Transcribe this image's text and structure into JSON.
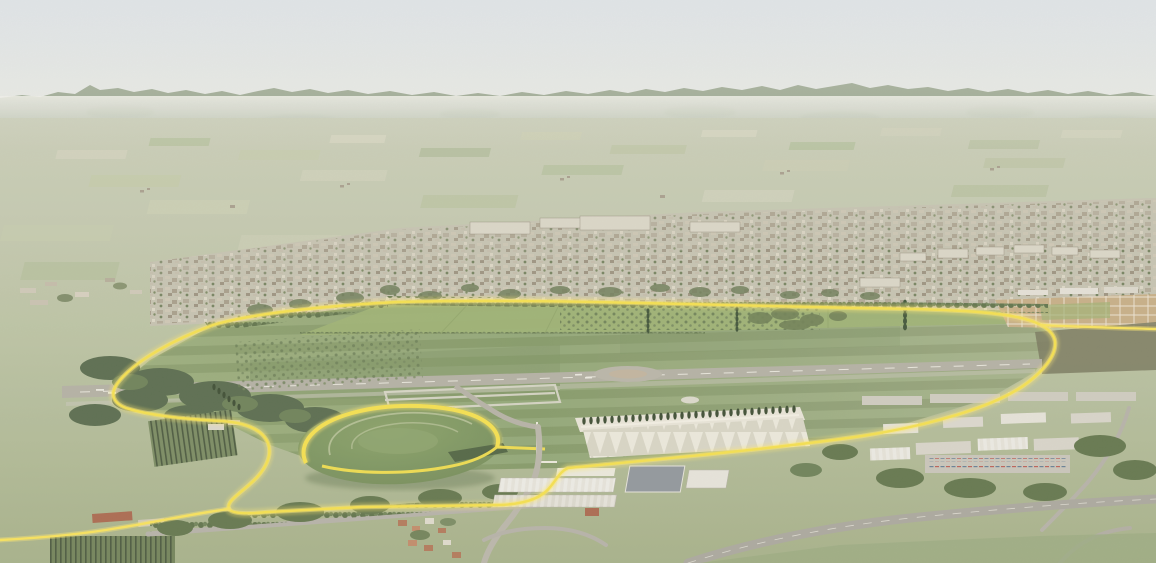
{
  "meta": {
    "type": "aerial-architectural-rendering",
    "subject": "Bird's-eye masterplan visualization of a large linear park on a former airfield. A glowing yellow loop path rings a vast mown meadow with a grey runway; a terraced elliptical grass mound sits at the south-west, a cypress colonnade and sports terraces at the south, orchards and allotment grids at the edges. Beyond the park: suburban city fabric, a hazy agricultural plain and an Apennine mountain ridge under a pale sky.",
    "width_px": 1156,
    "height_px": 563
  },
  "palette": {
    "sky_top": "#d9e0e8",
    "sky_horizon": "#e9ebe6",
    "mountain_far": "#98a68f",
    "hills_near": "#aab596",
    "haze_white": "#f2f2ec",
    "plain_top": "#cbcfba",
    "plain_bottom": "#a5b188",
    "city_base": "#c6c2b1",
    "city_building": "#b1a896",
    "city_white_slab": "#dbd7c9",
    "city_tree": "#6d7c58",
    "meadow_left": "#93a873",
    "meadow_mid": "#89a06c",
    "meadow_right": "#9fae83",
    "north_strip": "#9cb172",
    "runway_grey": "#b3b0a4",
    "runway_marking": "#f2f1e8",
    "path_yellow": "#f7e24a",
    "path_glow": "#ffe96e",
    "hedge_dark": "#4c6140",
    "woodland": "#55694a",
    "tree_row": "#5c7047",
    "mound_light": "#87a066",
    "mound_dark": "#6d8753",
    "terrace_line": "#b9c49a",
    "colonnade_white": "#e9e6da",
    "cypress_dark": "#38492f",
    "warehouse_roof": "#e7e5dd",
    "warehouse_dark_roof": "#8f959b",
    "road_grey": "#b5b2a8",
    "highway_grey": "#a9a79d",
    "vineyard_dark": "#46553a",
    "allotment_tan": "#c7ae85",
    "scrub_dark": "#77775c",
    "village_roof": "#b27657"
  },
  "features": [
    {
      "id": "sky",
      "label": "pale hazy sky"
    },
    {
      "id": "mountain-ridge",
      "label": "Apennine mountain ridge on horizon"
    },
    {
      "id": "agricultural-plain",
      "label": "patchwork farmland plain"
    },
    {
      "id": "city-band",
      "label": "suburban city fabric in middle distance"
    },
    {
      "id": "park-meadow",
      "label": "large mown park meadow (former airfield)"
    },
    {
      "id": "runway",
      "label": "disused grey runway with white markings"
    },
    {
      "id": "perimeter-path",
      "label": "glowing yellow perimeter loop path"
    },
    {
      "id": "grass-mound",
      "label": "terraced elliptical grass mound with yellow ring path"
    },
    {
      "id": "colonnade",
      "label": "white terraces with cypress colonnade"
    },
    {
      "id": "tree-rows",
      "label": "planted tree rows and orchard grids"
    },
    {
      "id": "allotments",
      "label": "tan allotment/nursery grid at east edge"
    },
    {
      "id": "vineyards",
      "label": "striped vineyard plots"
    },
    {
      "id": "industrial-zone",
      "label": "white warehouses and truck yards"
    },
    {
      "id": "highway",
      "label": "highway curving across the foreground"
    },
    {
      "id": "village",
      "label": "small red-roofed village in foreground"
    }
  ]
}
